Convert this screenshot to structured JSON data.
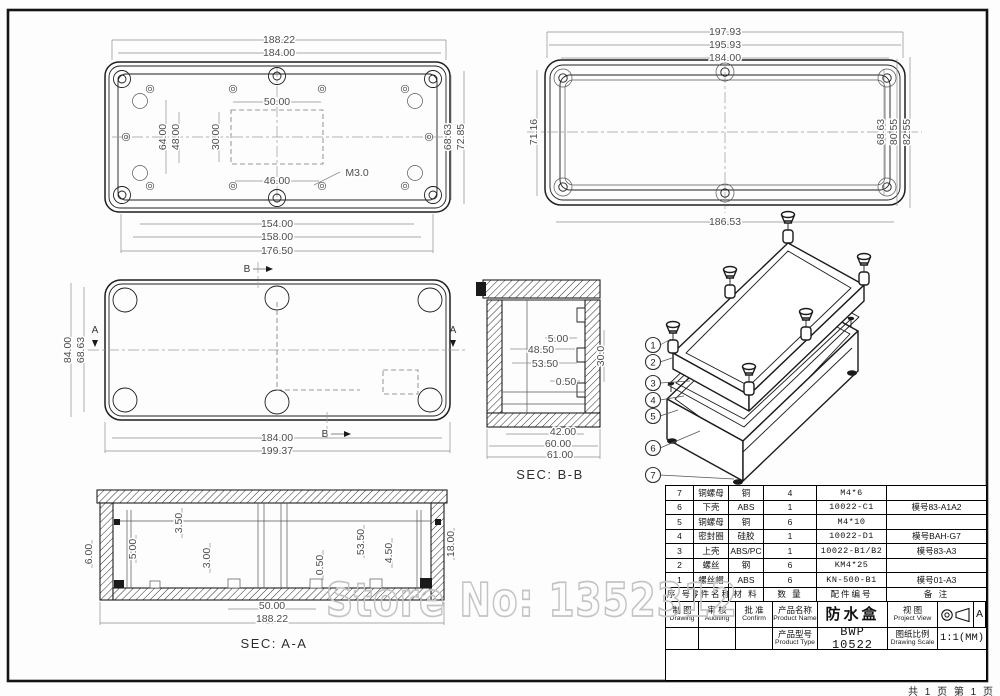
{
  "sheet": {
    "page_footer": "共 1 页  第 1 页"
  },
  "watermark": {
    "text": "Store No: 1352312"
  },
  "views": {
    "top_left": {
      "dims": {
        "w_outer": "188.22",
        "w_inner": "184.00",
        "left_outer": "64.00",
        "left_inner": "48.00",
        "cutout_w": "50.00",
        "cutout_h": "30.00",
        "cutout_b": "46.00",
        "thread": "M3.0",
        "right_inner": "68.63",
        "right_outer": "72.85",
        "b1": "154.00",
        "b2": "158.00",
        "b3": "176.50"
      }
    },
    "top_right": {
      "dims": {
        "t1": "197.93",
        "t2": "195.93",
        "t3": "184.00",
        "left": "71.16",
        "r1": "68.63",
        "r2": "80.55",
        "r3": "82.55",
        "bottom": "186.53"
      }
    },
    "mid_left": {
      "dims": {
        "l1": "84.00",
        "l2": "68.63",
        "b1": "184.00",
        "b2": "199.37"
      },
      "marker_a": "A",
      "marker_b": "B"
    },
    "sec_bb": {
      "label": "SEC: B-B",
      "dims": {
        "d1": "5.00",
        "d2": "48.50",
        "d3": "53.50",
        "d4": "0.50",
        "right": "30.0",
        "b1": "42.00",
        "b2": "60.00",
        "b3": "61.00"
      }
    },
    "sec_aa": {
      "label": "SEC: A-A",
      "dims": {
        "v1": "6.00",
        "v2": "5.00",
        "v3": "3.50",
        "v4": "3.00",
        "v5": "0.50",
        "v6": "53.50",
        "v7": "4.50",
        "v8": "18.00",
        "b1": "50.00",
        "b2": "188.22"
      }
    },
    "iso": {
      "callouts": [
        "1",
        "2",
        "3",
        "4",
        "5",
        "6",
        "7"
      ]
    }
  },
  "bom": {
    "headers": [
      "序 号",
      "零件名称",
      "材 料",
      "数 量",
      "配件编号",
      "备 注"
    ],
    "rows": [
      {
        "no": "7",
        "name": "铜螺母",
        "material": "铜",
        "qty": "4",
        "part_no": "M4*6",
        "note": ""
      },
      {
        "no": "6",
        "name": "下壳",
        "material": "ABS",
        "qty": "1",
        "part_no": "10022-C1",
        "note": "模号83-A1A2"
      },
      {
        "no": "5",
        "name": "铜螺母",
        "material": "铜",
        "qty": "6",
        "part_no": "M4*10",
        "note": ""
      },
      {
        "no": "4",
        "name": "密封圈",
        "material": "硅胶",
        "qty": "1",
        "part_no": "10022-D1",
        "note": "模号BAH-G7"
      },
      {
        "no": "3",
        "name": "上壳",
        "material": "ABS/PC",
        "qty": "1",
        "part_no": "10022-B1/B2",
        "note": "模号83-A3"
      },
      {
        "no": "2",
        "name": "螺丝",
        "material": "钢",
        "qty": "6",
        "part_no": "KM4*25",
        "note": ""
      },
      {
        "no": "1",
        "name": "螺丝帽",
        "material": "ABS",
        "qty": "6",
        "part_no": "KN-500-B1",
        "note": "模号01-A3"
      }
    ]
  },
  "title_block": {
    "drawing_zh": "制 图",
    "drawing_en": "Drawing",
    "auditing_zh": "审 核",
    "auditing_en": "Auditing",
    "confirm_zh": "批 准",
    "confirm_en": "Confirm",
    "product_name_zh": "产品名称",
    "product_name_en": "Product Name",
    "product_name": "防水盒",
    "product_type_zh": "产品型号",
    "product_type_en": "Product Type",
    "product_type": "BWP 10522",
    "view_zh": "视 图",
    "view_en": "Project View",
    "revision": "A",
    "scale_zh": "图纸比例",
    "scale_en": "Drawing Scale",
    "scale": "1:1(MM)"
  }
}
